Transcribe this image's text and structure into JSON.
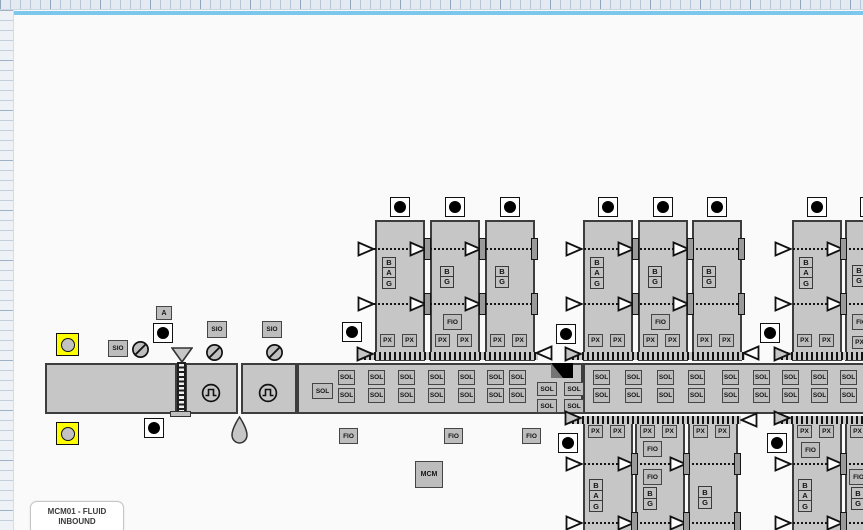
{
  "title": {
    "line1": "MCM01 - FLUID",
    "line2": "INBOUND"
  },
  "labels": {
    "sio": "SIO",
    "sol": "SOL",
    "fio": "FIO",
    "px": "PX",
    "mcm": "MCM",
    "a": "A",
    "b": "B",
    "g": "G"
  },
  "icons": {
    "instrument": "filled-circle",
    "instrument_highlight": "circle-in-yellow-square",
    "closed_valve": "slashed-circle",
    "pump": "pulse-wave-circle",
    "funnel": "triangle-down",
    "drain": "teardrop",
    "collapsed_marker": "black-corner-fold",
    "flow_valve": "hollow-triangle-arrow"
  },
  "colors": {
    "page_edge_blue": "#7cc7ec",
    "shape_fill": "#c6c6c6",
    "label_fill": "#bdbdbd",
    "highlight_yellow": "#ffff00",
    "line_black": "#151515",
    "grid_bg": "#e4eaf1"
  }
}
